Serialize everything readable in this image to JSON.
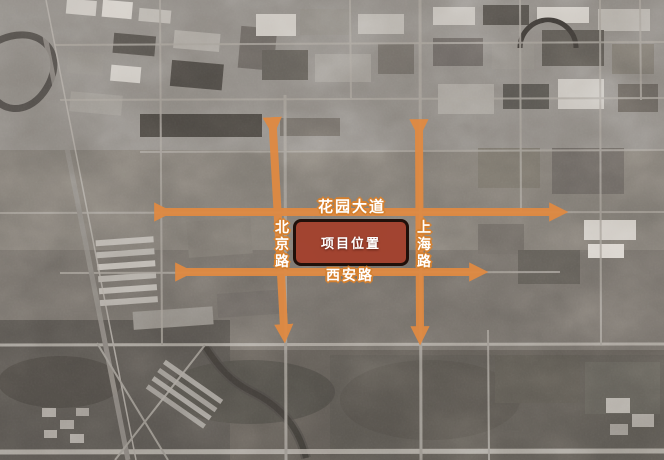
{
  "roads": {
    "huayuan": {
      "label": "花园大道",
      "orientation": "horizontal"
    },
    "beijing": {
      "label": "北京路",
      "orientation": "vertical"
    },
    "shanghai": {
      "label": "上海路",
      "orientation": "vertical"
    },
    "xian": {
      "label": "西安路",
      "orientation": "horizontal"
    }
  },
  "project": {
    "label": "项目位置"
  },
  "colors": {
    "road_arrow_orange": "#e08a42",
    "label_text": "#ffffff",
    "label_outline": "#d5802f",
    "project_fill": "#a3402c",
    "project_border": "#20100a",
    "satellite_base_gray": "#7e7973"
  }
}
